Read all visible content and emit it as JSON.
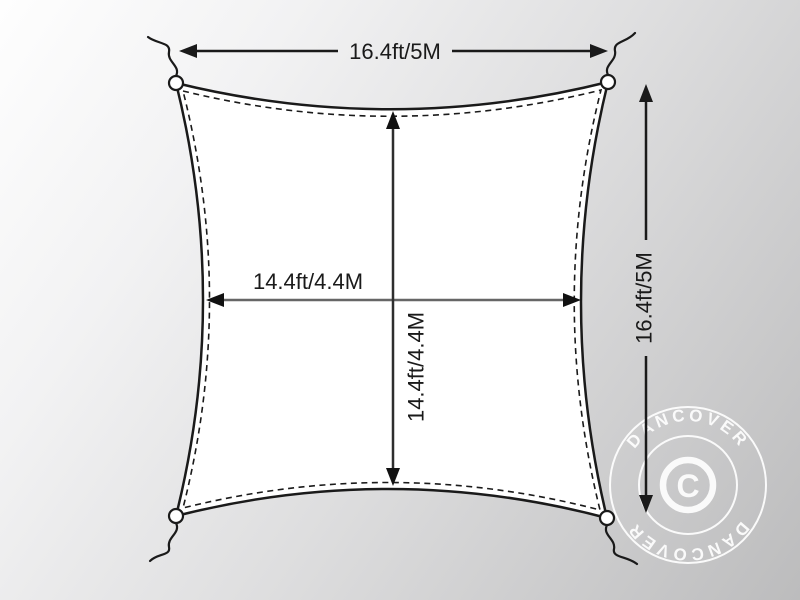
{
  "diagram": {
    "dimensions": {
      "top_width": "16.4ft/5M",
      "side_height": "16.4ft/5M",
      "inner_width": "14.4ft/4.4M",
      "inner_height": "14.4ft/4.4M"
    },
    "watermark": {
      "arc_top": "DANCOVER",
      "arc_bottom": "DANCOVER",
      "center_symbol": "C"
    },
    "colors": {
      "outline": "#1a1a1a",
      "inner_width_line": "#666666",
      "inner_height_line": "#2e2e2e",
      "sail_fill": "#ffffff",
      "watermark": "#ffffff",
      "background_start": "#fefefe",
      "background_end": "#bcbcbd"
    }
  }
}
